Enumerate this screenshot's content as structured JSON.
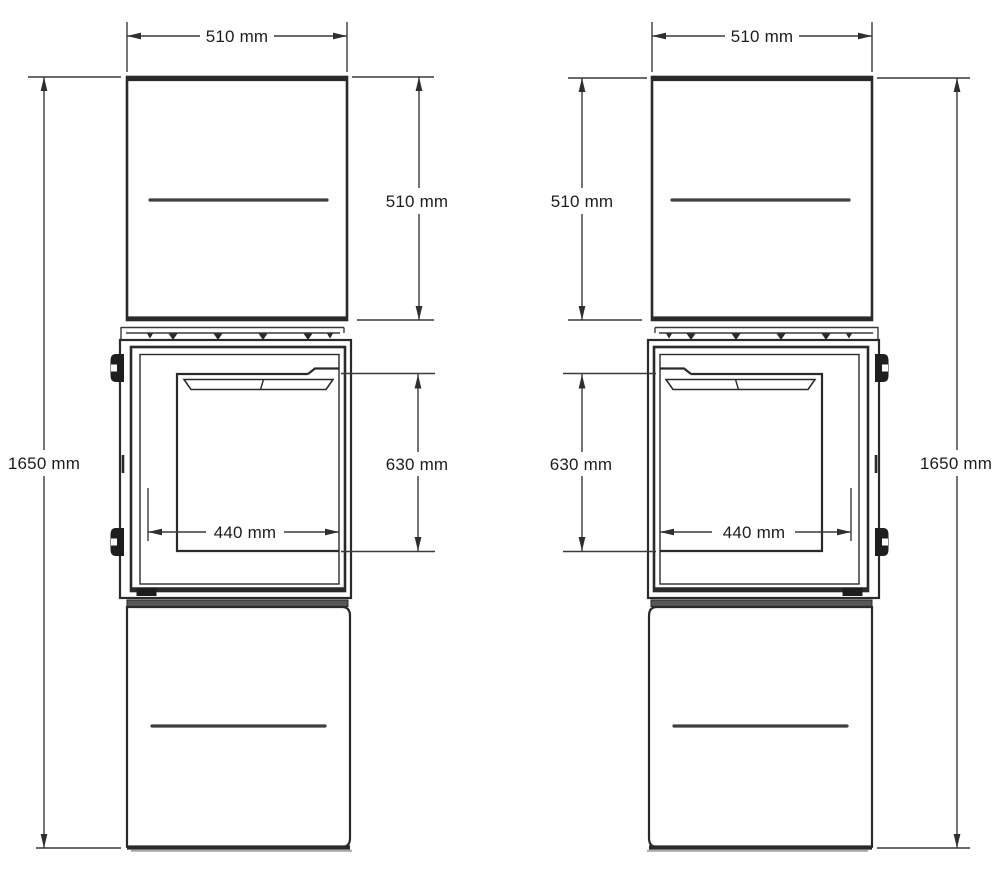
{
  "views": {
    "left": {
      "overall_width": "510 mm",
      "upper_section_height": "510 mm",
      "door_glass_height": "630 mm",
      "door_glass_width": "440 mm",
      "overall_height": "1650 mm"
    },
    "right": {
      "overall_width": "510 mm",
      "upper_section_height": "510 mm",
      "door_glass_height": "630 mm",
      "door_glass_width": "440 mm",
      "overall_height": "1650 mm"
    }
  },
  "colors": {
    "line": "#2a2a2a",
    "dimension_line": "#3a3a3a",
    "text": "#1d1d1d",
    "joint_strip": "#575757",
    "background": "#ffffff"
  }
}
